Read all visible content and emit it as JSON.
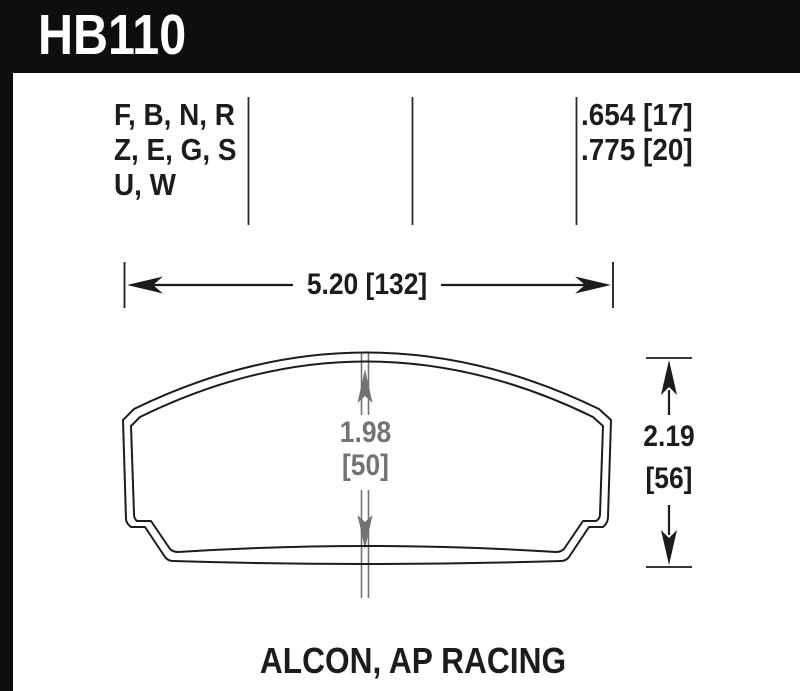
{
  "header": {
    "part_number": "HB110"
  },
  "spec_table": {
    "compound_codes": "F, B, N, R\nZ, E, G, S\nU, W",
    "thickness_values": ".654 [17]\n.775 [20]"
  },
  "dimensions": {
    "width_label": "5.20 [132]",
    "overall_height_in": "2.19",
    "overall_height_mm": "[56]",
    "pad_height_in": "1.98",
    "pad_height_mm": "[50]"
  },
  "footer": {
    "applications": "ALCON, AP RACING"
  },
  "colors": {
    "header_bg": "#0e0e0e",
    "line_black": "#1c1c1c",
    "dimension_gray": "#737373",
    "background": "#ffffff"
  }
}
